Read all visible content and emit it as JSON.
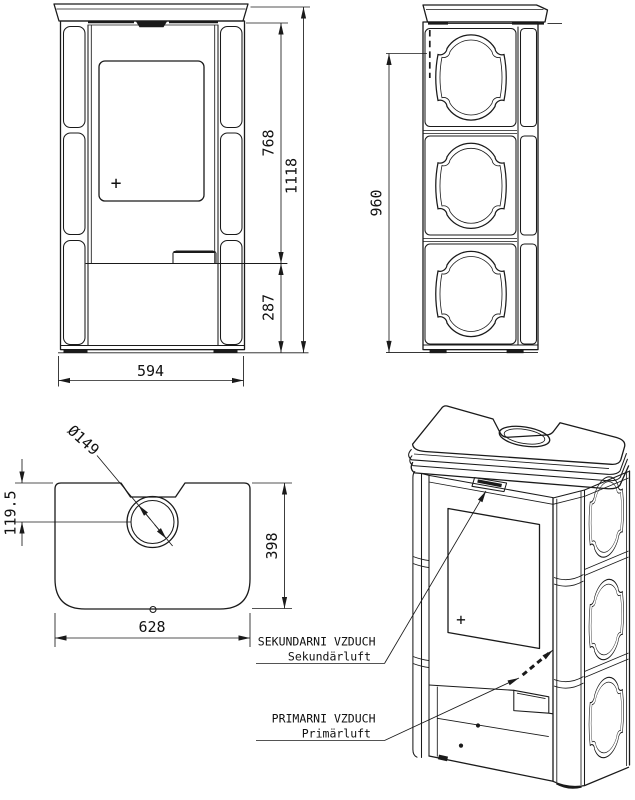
{
  "drawing": {
    "front_view": {
      "dim_firebox_height": "768",
      "dim_total_height": "1118",
      "dim_base_height": "287",
      "dim_width": "594",
      "handle_mark": "+"
    },
    "side_view": {
      "dim_body_height": "960"
    },
    "top_view": {
      "dim_flue_diameter": "Ø149",
      "dim_flue_center_offset": "119.5",
      "dim_depth": "398",
      "dim_width": "628"
    },
    "iso_view": {
      "handle_mark": "+",
      "labels": {
        "secondary_air_cs": "SEKUNDARNI VZDUCH",
        "secondary_air_de": "Sekundärluft",
        "primary_air_cs": "PRIMARNI VZDUCH",
        "primary_air_de": "Primärluft"
      }
    },
    "colors": {
      "line": "#1a1a1a",
      "background": "#ffffff"
    }
  }
}
